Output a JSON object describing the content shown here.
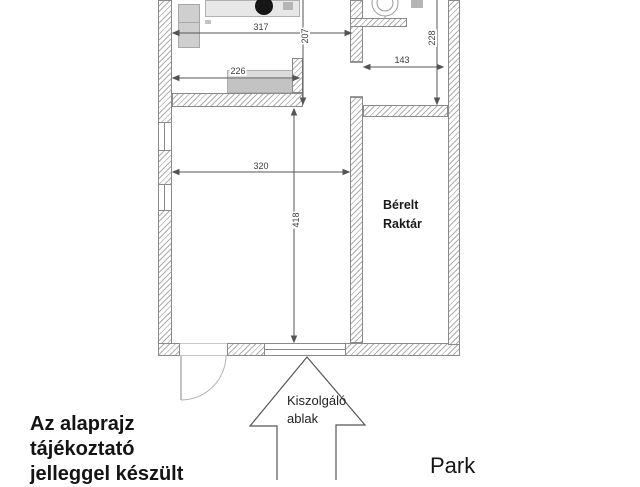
{
  "plan": {
    "dims": {
      "top_width": "317",
      "top_depth": "207",
      "counter_width": "226",
      "main_room_width": "320",
      "main_room_depth": "418",
      "right_room_width": "143",
      "right_room_depth": "228"
    },
    "rooms": {
      "rented_storage_line1": "Bérelt",
      "rented_storage_line2": "Raktár"
    },
    "callout": {
      "line1": "Kiszolgáló",
      "line2": "ablak"
    }
  },
  "footer": {
    "disclaimer_line1": "Az alaprajz",
    "disclaimer_line2": "tájékoztató",
    "disclaimer_line3": "jelleggel készült",
    "park_label": "Park"
  }
}
